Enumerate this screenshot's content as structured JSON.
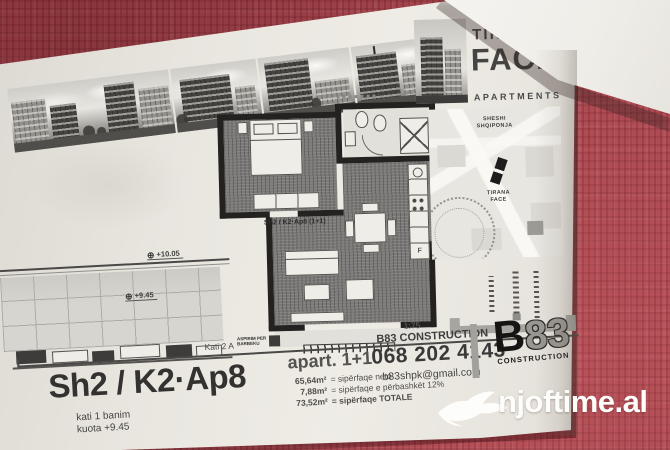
{
  "colors": {
    "cloth_red": "#a84750",
    "paper": "#e9e6e0",
    "ink": "#3b3a38",
    "logo_gray": "#999791",
    "watermark_white": "#fdfdfc"
  },
  "brand": {
    "name_top": "TIRANA",
    "name_main": "FACE",
    "name_sub": "APARTMENTS"
  },
  "map": {
    "plaza_line1": "SHESHI",
    "plaza_line2": "SHQIPONJA",
    "building_line1": "TIRANA",
    "building_line2": "FACE"
  },
  "plan": {
    "unit_label": "Sh2 / K2·Ap8 (1+1)",
    "vent_note_line1": "ASPIRIM PER",
    "vent_note_line2": "BARBEKU",
    "fridge_letter": "F",
    "level_upper": "+10.05",
    "level_lower": "+9.45",
    "floor_label": "Kati 2 A",
    "scale": "1:75",
    "sheet_number": "2"
  },
  "title_block": {
    "unit_title": "Sh2 / K2·Ap8",
    "floor_line": "kati 1 banim",
    "elevation_line": "kuota +9.45",
    "apartment_type": "apart. 1+1",
    "areas": [
      {
        "value": "65,64m²",
        "label": "= sipërfaqe neto"
      },
      {
        "value": "7,88m²",
        "label": "= sipërfaqe e përbashkët 12%"
      },
      {
        "value": "73,52m²",
        "label": "= sipërfaqe TOTALE"
      }
    ],
    "company": "B83 CONSTRUCTION",
    "phone": "068 202 4143",
    "email": "b83shpk@gmail.com",
    "logo": {
      "b": "B",
      "eight_three": "83",
      "sub": "CONSTRUCTION"
    }
  },
  "watermark": {
    "site": "njoftime.al"
  }
}
